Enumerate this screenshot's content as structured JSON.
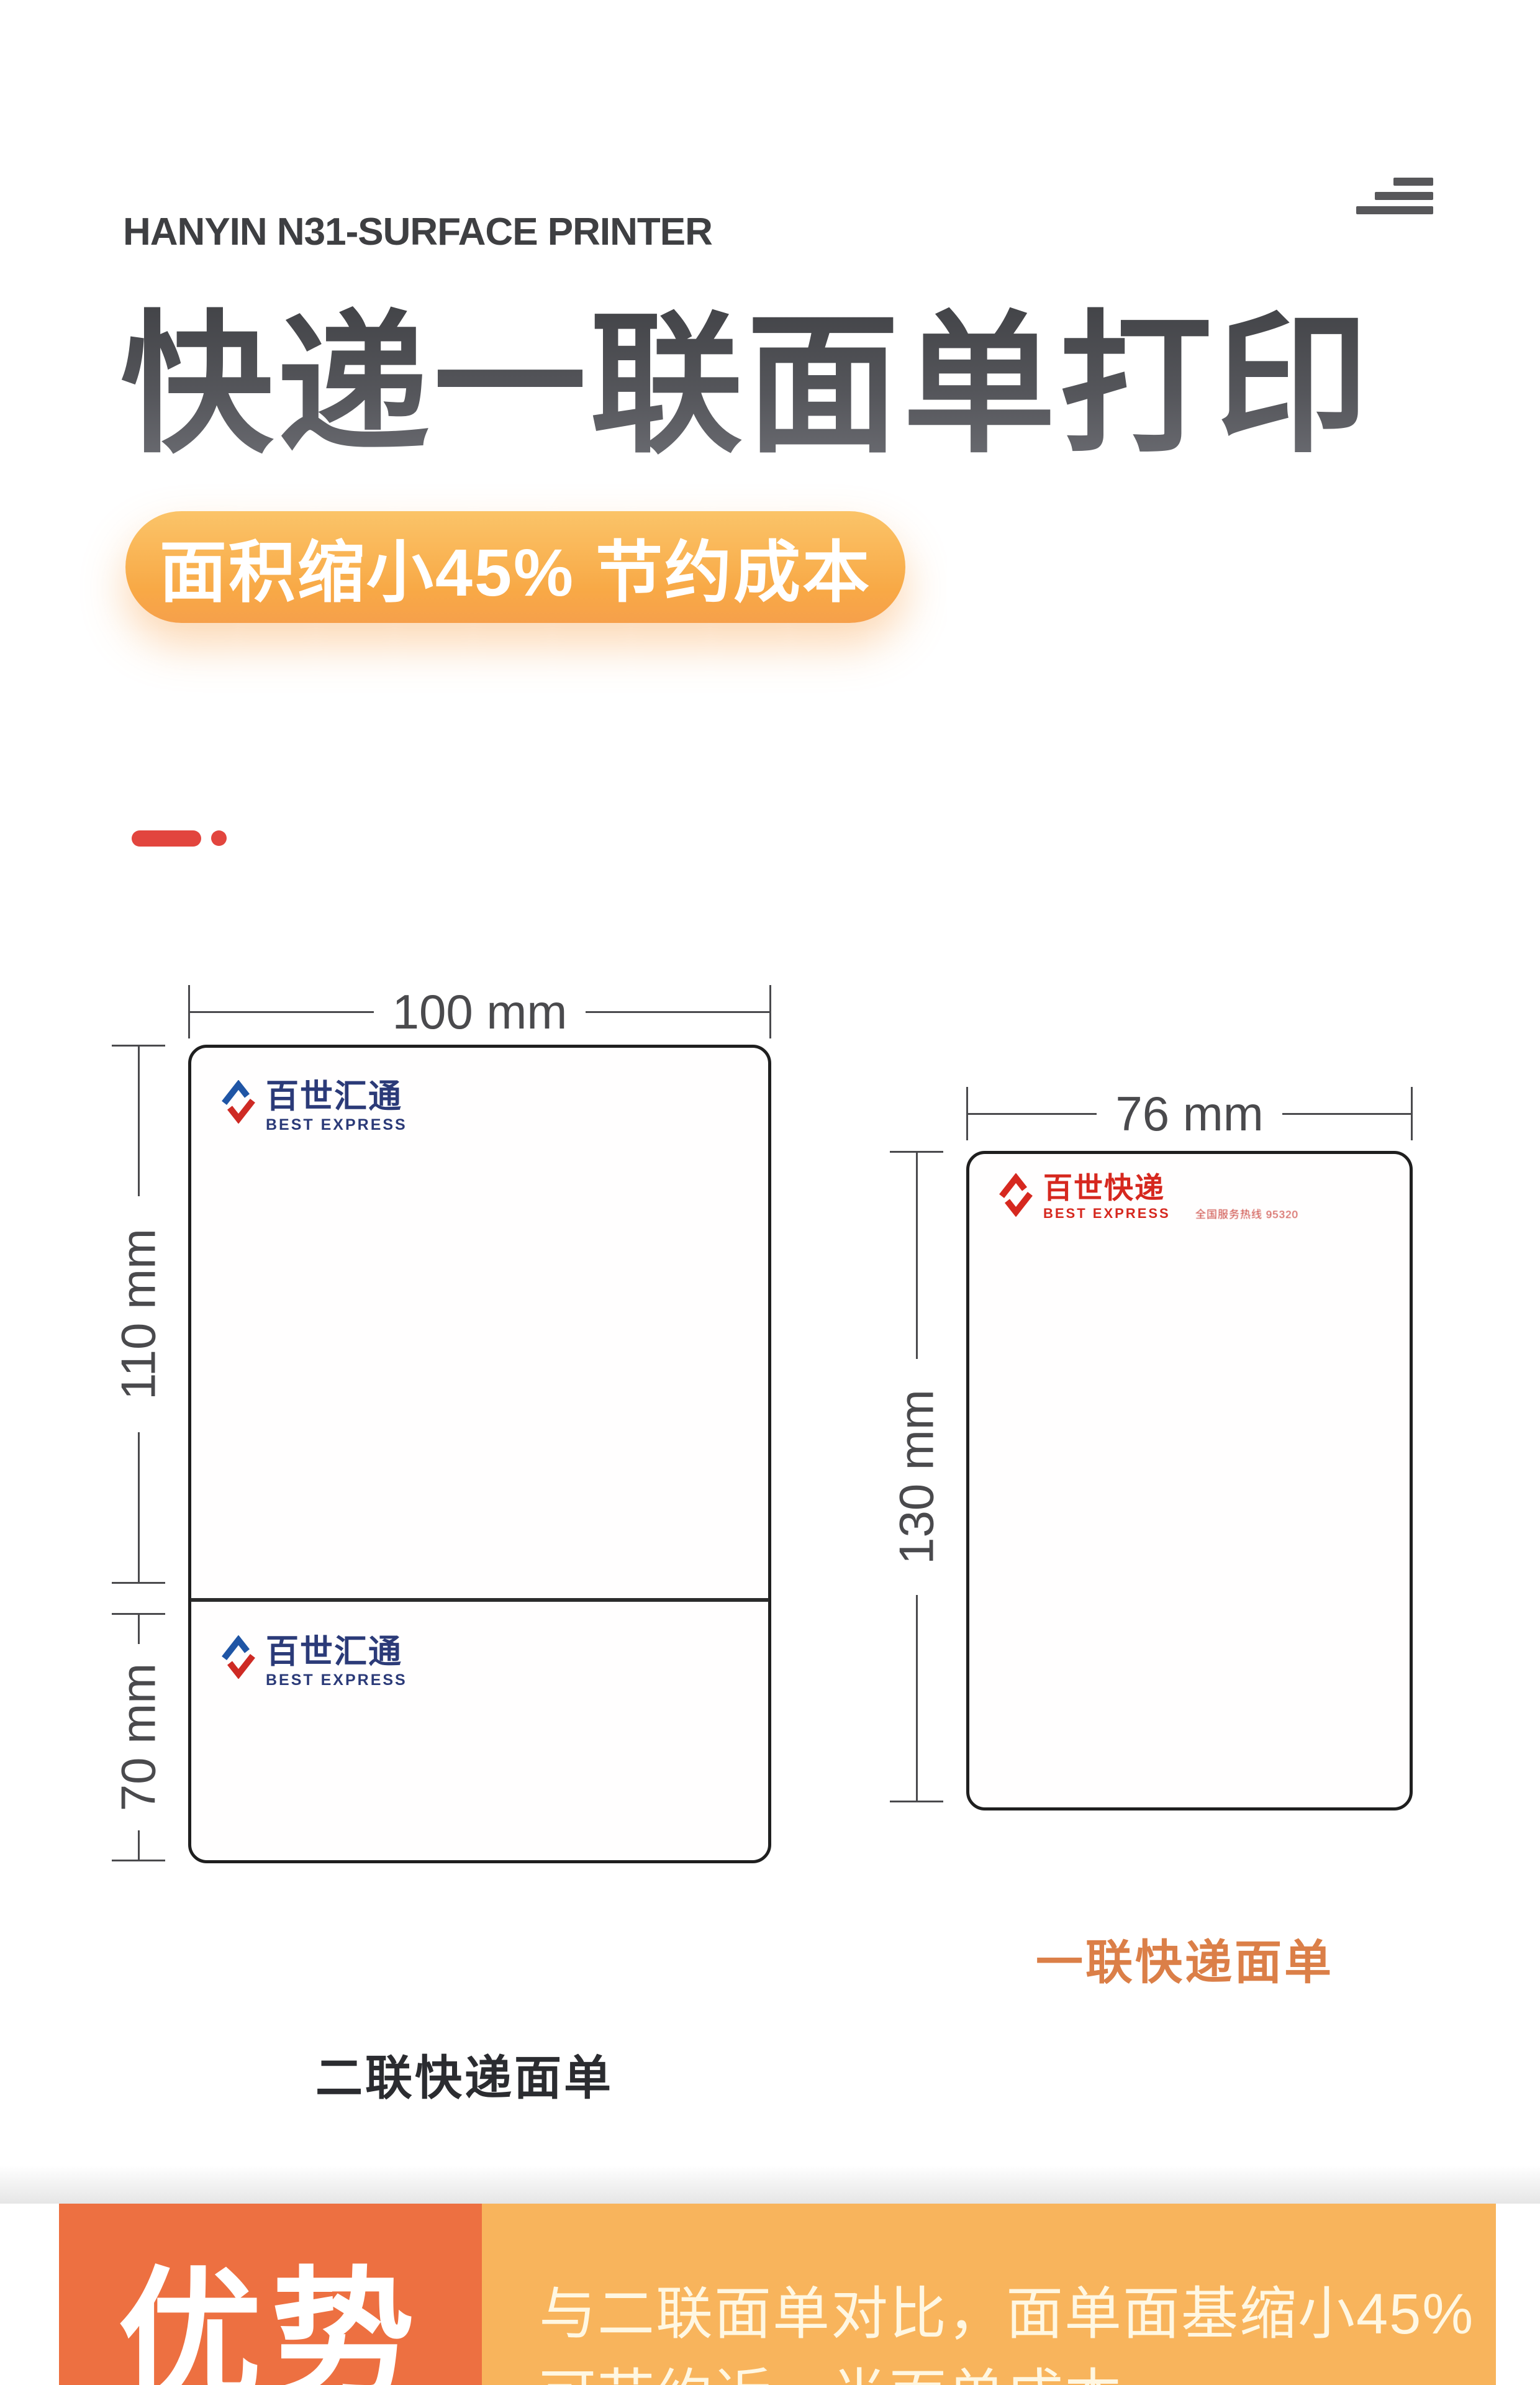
{
  "header": {
    "product_title": "HANYIN N31-SURFACE PRINTER"
  },
  "hero": {
    "title": "快递一联面单打印",
    "badge": "面积缩小45% 节约成本"
  },
  "diagram": {
    "two_part": {
      "width_dim": "100 mm",
      "upper_dim": "110 mm",
      "lower_dim": "70 mm",
      "caption": "二联快递面单",
      "logo_cn": "百世汇通",
      "logo_en": "BEST EXPRESS"
    },
    "one_part": {
      "width_dim": "76 mm",
      "height_dim": "130 mm",
      "caption": "一联快递面单",
      "logo_cn": "百世快递",
      "logo_en": "BEST EXPRESS",
      "hotline": "全国服务热线 95320"
    }
  },
  "advantage": {
    "title": "优势",
    "line1": "与二联面单对比，面单面基缩小45%",
    "line2": "可节约近一半面单成本"
  },
  "colors": {
    "badge_orange": "#F8A946",
    "deep_orange": "#ED7041",
    "light_orange": "#F8B45C",
    "accent_red": "#E2453E",
    "logo_blue": "#2B3A78",
    "logo_red": "#D6281F",
    "title_gray": "#55565B"
  }
}
